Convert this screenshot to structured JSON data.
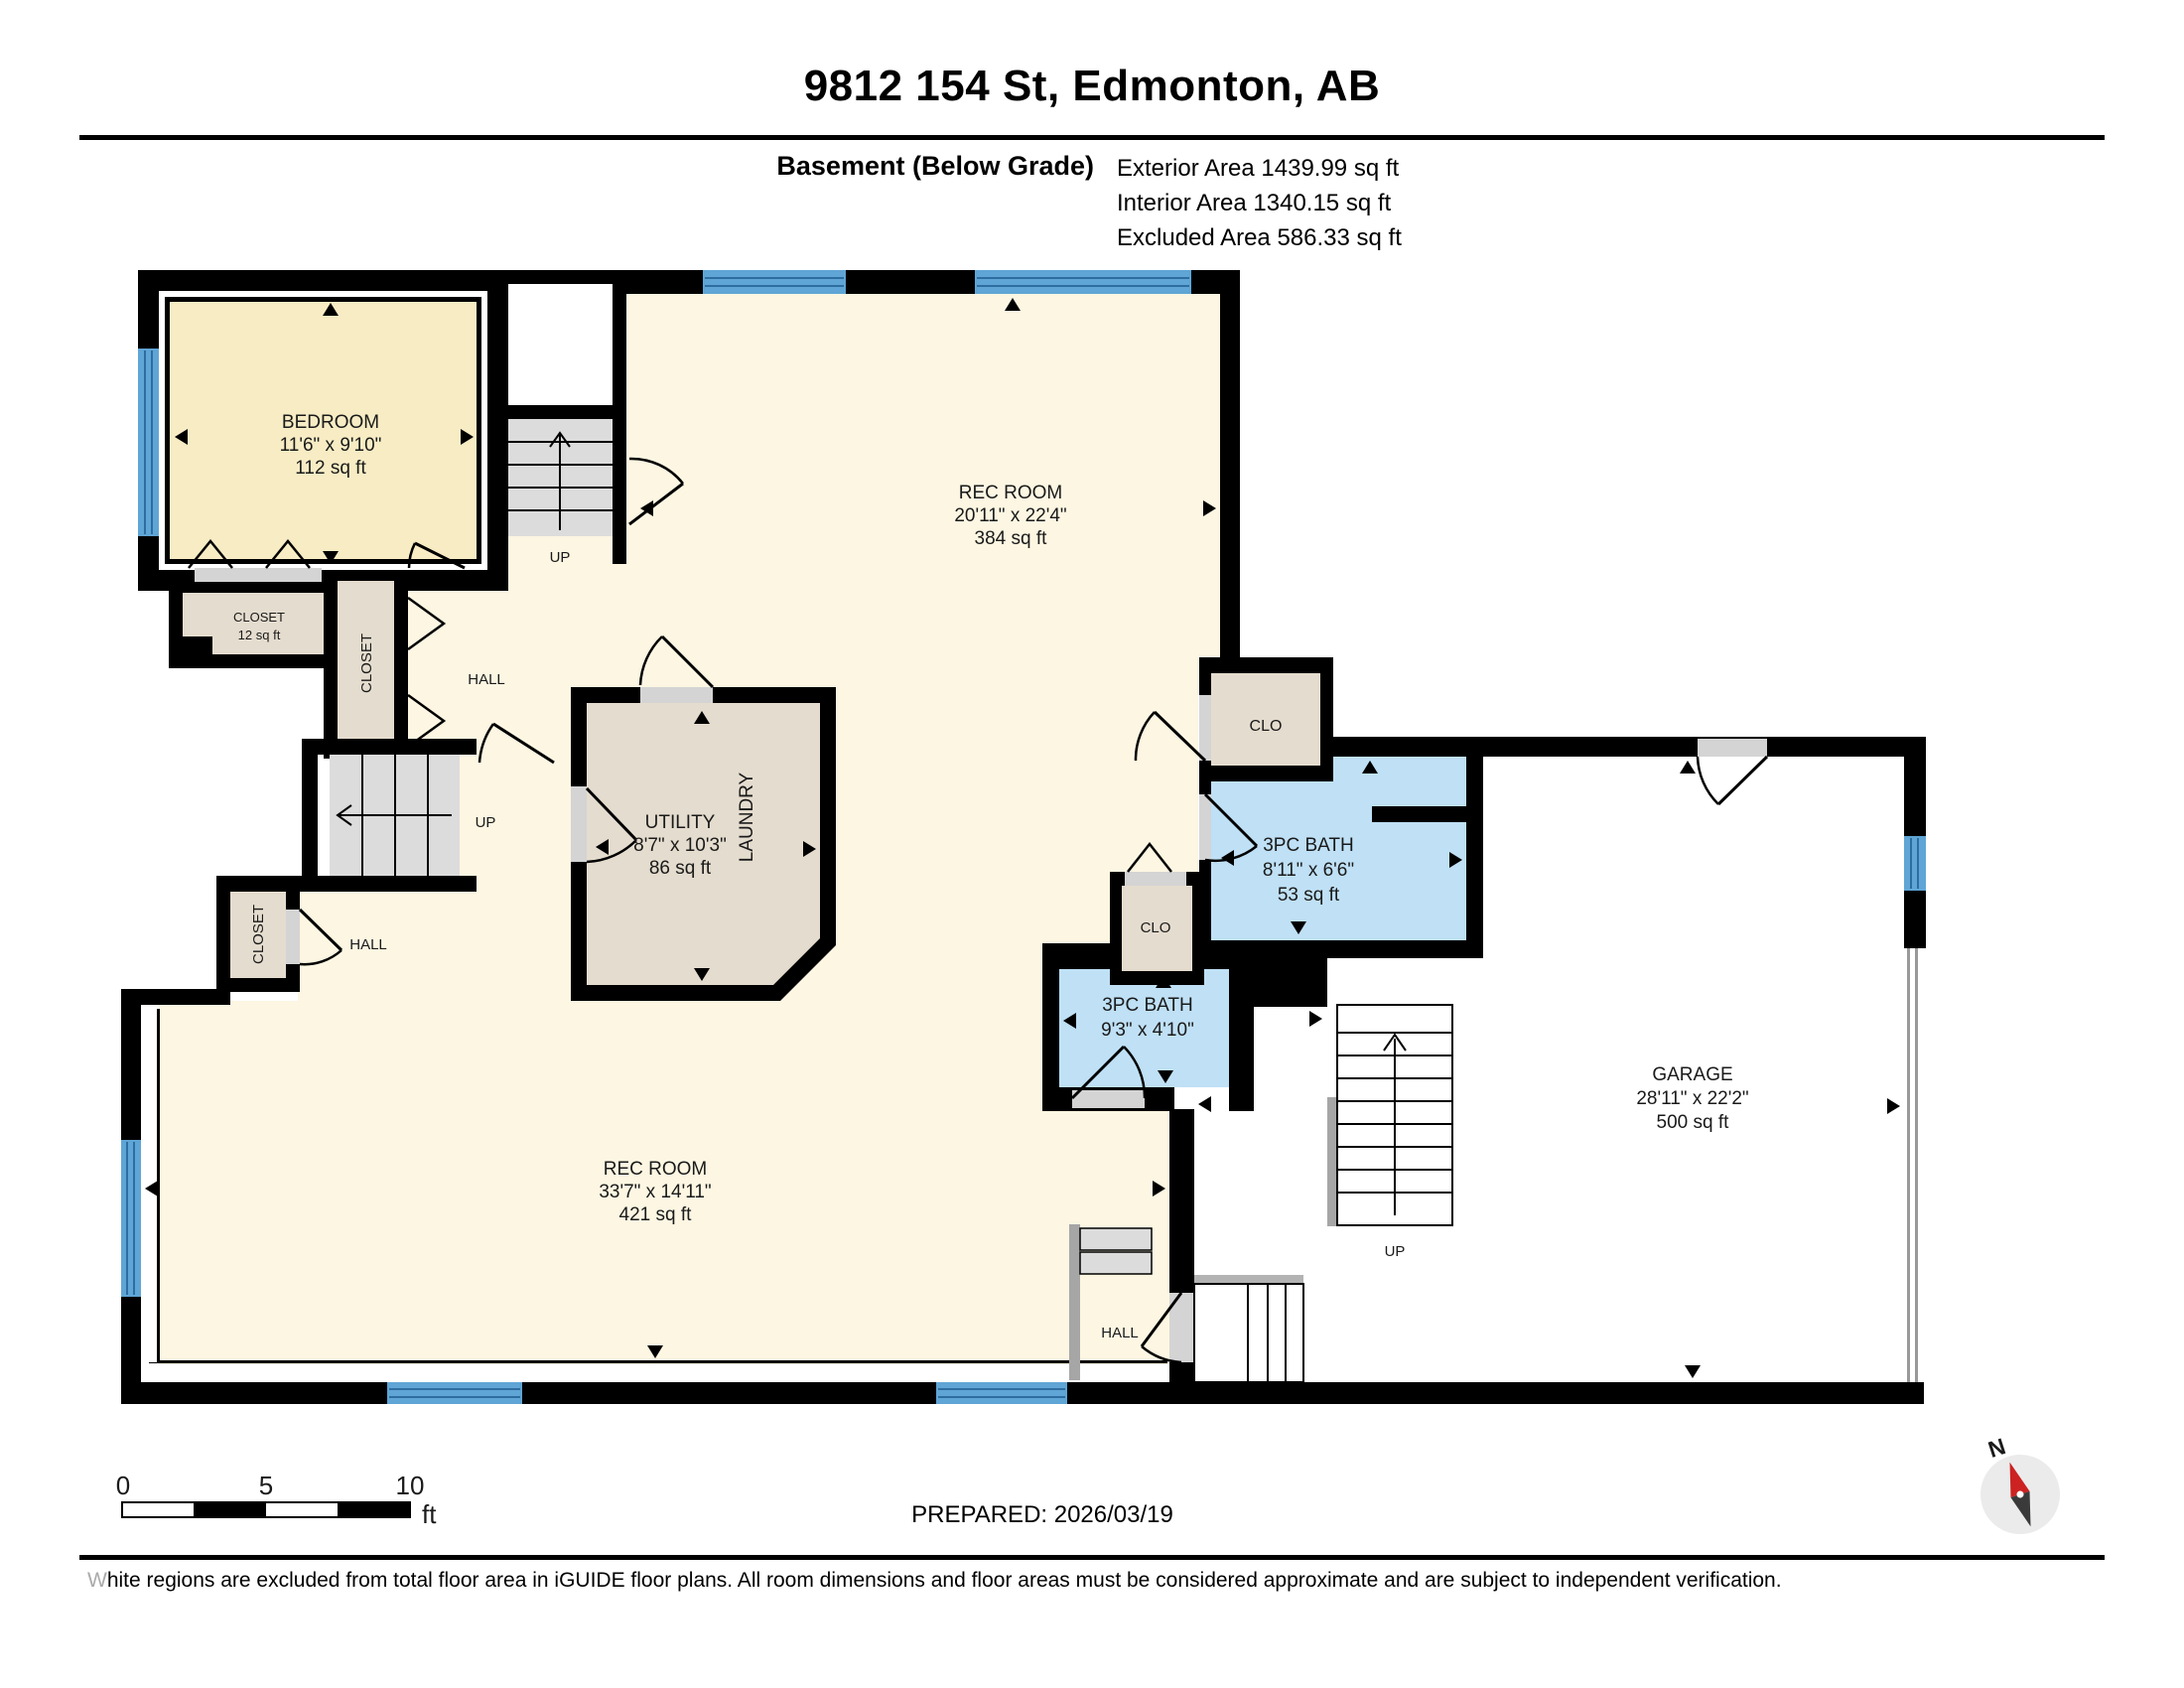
{
  "header": {
    "title": "9812 154 St, Edmonton, AB",
    "floor_label": "Basement (Below Grade)",
    "areas": [
      "Exterior Area 1439.99 sq ft",
      "Interior Area 1340.15 sq ft",
      "Excluded Area 586.33 sq ft"
    ]
  },
  "rooms": {
    "bedroom": {
      "name": "BEDROOM",
      "dims": "11'6\" x 9'10\"",
      "area": "112 sq ft"
    },
    "closet_bedroom": {
      "name": "CLOSET",
      "area": "12 sq ft"
    },
    "closet_upper": {
      "name": "CLOSET"
    },
    "closet_lower": {
      "name": "CLOSET"
    },
    "hall_upper": {
      "name": "HALL"
    },
    "hall_middle": {
      "name": "HALL"
    },
    "hall_lower": {
      "name": "HALL"
    },
    "rec_room_upper": {
      "name": "REC ROOM",
      "dims": "20'11\" x 22'4\"",
      "area": "384 sq ft"
    },
    "utility": {
      "name": "UTILITY",
      "dims": "8'7\" x 10'3\"",
      "area": "86 sq ft"
    },
    "laundry": {
      "name": "LAUNDRY"
    },
    "clo_upper": {
      "name": "CLO"
    },
    "clo_lower": {
      "name": "CLO"
    },
    "bath_upper": {
      "name": "3PC BATH",
      "dims": "8'11\" x 6'6\"",
      "area": "53 sq ft"
    },
    "bath_lower": {
      "name": "3PC BATH",
      "dims": "9'3\" x 4'10\""
    },
    "rec_room_lower": {
      "name": "REC ROOM",
      "dims": "33'7\" x 14'11\"",
      "area": "421 sq ft"
    },
    "garage": {
      "name": "GARAGE",
      "dims": "28'11\" x 22'2\"",
      "area": "500 sq ft"
    }
  },
  "stairs": {
    "up1": "UP",
    "up2": "UP",
    "up3": "UP"
  },
  "scale_bar": {
    "t0": "0",
    "t5": "5",
    "t10": "10",
    "unit": "ft"
  },
  "compass": {
    "north": "N"
  },
  "footer": {
    "prepared": "PREPARED: 2026/03/19",
    "disclaimer": "White regions are excluded from total floor area in iGUIDE floor plans. All room dimensions and floor areas must be considered approximate and are subject to independent verification."
  },
  "colors": {
    "wall": "#000000",
    "room_cream": "#FCF6E2",
    "bedroom_cream": "#F7ECC4",
    "closet_tan": "#E4DCCE",
    "bath_blue": "#BFE0F5",
    "window_blue": "#5FA5D5",
    "stair_gray": "#DCDCDC",
    "door_gray": "#D4D4D4",
    "railing_gray": "#A6A6A6",
    "compass_red": "#CC2222"
  }
}
